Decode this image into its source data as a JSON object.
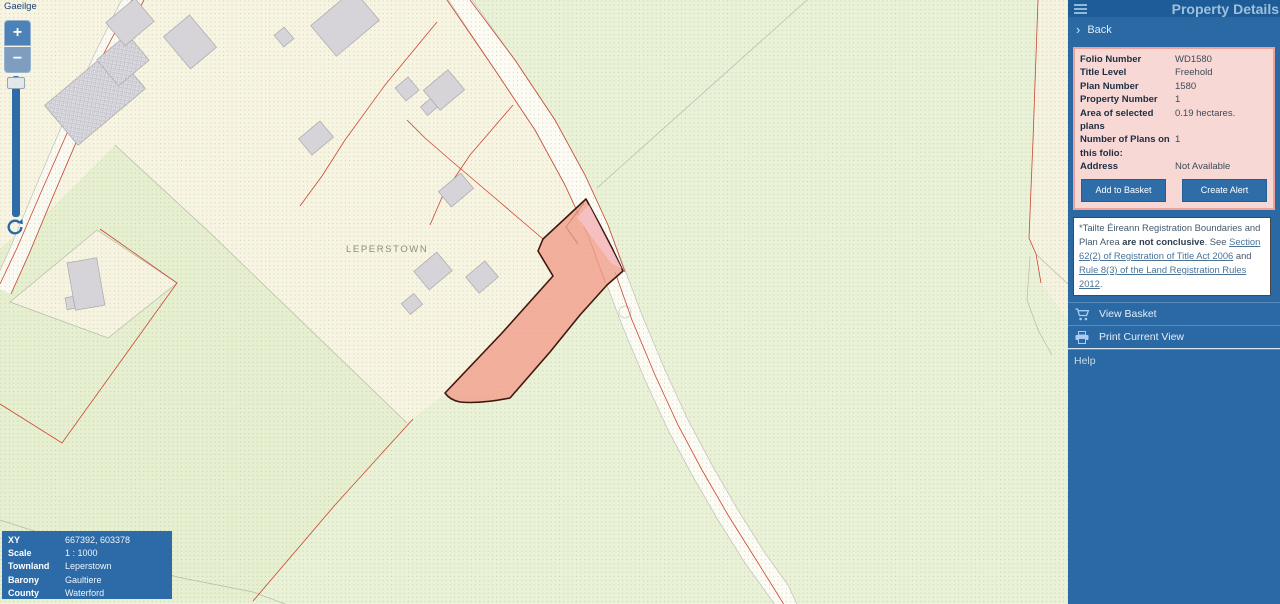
{
  "map": {
    "language_link": "Gaeilge",
    "townland_label": "LEPERSTOWN",
    "zoom_in": "+",
    "zoom_out": "−",
    "info_box": {
      "rows": [
        {
          "label": "XY",
          "value": "667392, 603378"
        },
        {
          "label": "Scale",
          "value": "1 : 1000"
        },
        {
          "label": "Townland",
          "value": "Leperstown"
        },
        {
          "label": "Barony",
          "value": "Gaultiere"
        },
        {
          "label": "County",
          "value": "Waterford"
        }
      ]
    }
  },
  "sidebar": {
    "title": "Property Details",
    "back_label": "Back",
    "details": {
      "rows": [
        {
          "label": "Folio Number",
          "value": "WD1580"
        },
        {
          "label": "Title Level",
          "value": "Freehold"
        },
        {
          "label": "Plan Number",
          "value": "1580"
        },
        {
          "label": "Property Number",
          "value": "1"
        },
        {
          "label": "Area of selected plans",
          "value": "0.19 hectares."
        },
        {
          "label": "Number of Plans on this folio:",
          "value": "1"
        },
        {
          "label": "Address",
          "value": "Not Available"
        }
      ],
      "buttons": {
        "add_to_basket": "Add to Basket",
        "create_alert": "Create Alert"
      }
    },
    "disclaimer": {
      "prefix": "*Tailte Éireann Registration Boundaries and Plan Area ",
      "bold": "are not conclusive",
      "mid": ". See ",
      "link1": "Section 62(2) of Registration of Title Act 2006",
      "conj": " and ",
      "link2": "Rule 8(3) of the Land Registration Rules 2012",
      "suffix": "."
    },
    "menu": {
      "view_basket": "View Basket",
      "print": "Print Current View",
      "help": "Help"
    }
  },
  "colors": {
    "sidebar_blue": "#2b69a4",
    "header_blue": "#1e5c98",
    "panel_pink_bg": "#f8d8d4",
    "panel_pink_border": "#efa29a",
    "parcel_highlight": "#f0a08c",
    "parcel_border": "#3f190f",
    "boundary_red": "#cb4733",
    "map_green": "#e9f1d6",
    "map_cream": "#f7f5e1"
  }
}
